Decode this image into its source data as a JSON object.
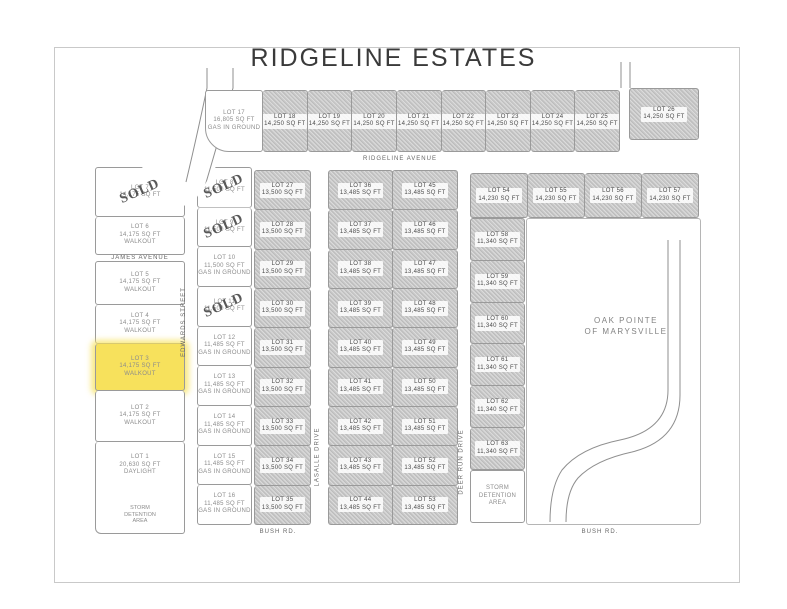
{
  "title": "RIDGELINE ESTATES",
  "stamps": {
    "sold": "SOLD"
  },
  "colors": {
    "highlight_yellow": "#f7e15c",
    "shaded_lot_gray": "#c8c8c8",
    "line_gray": "#9a9a9a",
    "text_gray": "#8c8c8c"
  },
  "streets": {
    "ridgeline": "RIDGELINE AVENUE",
    "james": "JAMES AVENUE",
    "edwards": "EDWARDS STREET",
    "lasalle": "LASALLE DRIVE",
    "deer_run": "DEER RUN DRIVE",
    "bush_left": "BUSH RD.",
    "bush_right": "BUSH RD."
  },
  "areas": {
    "oak_pointe_1": "OAK POINTE",
    "oak_pointe_2": "OF MARYSVILLE"
  },
  "lots": {
    "top_row": [
      {
        "label": "LOT 17",
        "area": "16,805 SQ FT",
        "note": "GAS IN GROUND",
        "state": "white"
      },
      {
        "label": "LOT 18",
        "area": "14,250 SQ FT",
        "state": "shaded"
      },
      {
        "label": "LOT 19",
        "area": "14,250 SQ FT",
        "state": "shaded"
      },
      {
        "label": "LOT 20",
        "area": "14,250 SQ FT",
        "state": "shaded"
      },
      {
        "label": "LOT 21",
        "area": "14,250 SQ FT",
        "state": "shaded"
      },
      {
        "label": "LOT 22",
        "area": "14,250 SQ FT",
        "state": "shaded"
      },
      {
        "label": "LOT 23",
        "area": "14,250 SQ FT",
        "state": "shaded"
      },
      {
        "label": "LOT 24",
        "area": "14,250 SQ FT",
        "state": "shaded"
      },
      {
        "label": "LOT 25",
        "area": "14,250 SQ FT",
        "state": "shaded"
      }
    ],
    "top_right": [
      {
        "label": "LOT 26",
        "area": "14,250 SQ FT",
        "state": "shaded"
      }
    ],
    "left_column": [
      {
        "label": "LOT 7",
        "area": "14,175 SQ FT",
        "state": "white",
        "sold": true
      },
      {
        "label": "LOT 6",
        "area": "14,175 SQ FT",
        "note": "WALKOUT",
        "state": "white"
      },
      {
        "street": "JAMES AVENUE"
      },
      {
        "label": "LOT 5",
        "area": "14,175 SQ FT",
        "note": "WALKOUT",
        "state": "white"
      },
      {
        "label": "LOT 4",
        "area": "14,175 SQ FT",
        "note": "WALKOUT",
        "state": "white"
      },
      {
        "label": "LOT 3",
        "area": "14,175 SQ FT",
        "note": "WALKOUT",
        "state": "highlight"
      },
      {
        "label": "LOT 2",
        "area": "14,175 SQ FT",
        "note": "WALKOUT",
        "state": "white"
      },
      {
        "label": "LOT 1",
        "area": "20,630 SQ FT",
        "note": "DAYLIGHT",
        "state": "white",
        "extra": "STORM DETENTION AREA"
      }
    ],
    "edwards_column": [
      {
        "label": "LOT 8",
        "area": "11,500 SQ FT",
        "state": "white",
        "sold": true
      },
      {
        "label": "LOT 9",
        "area": "11,500 SQ FT",
        "state": "white",
        "sold": true
      },
      {
        "label": "LOT 10",
        "area": "11,500 SQ FT",
        "note": "GAS IN GROUND",
        "state": "white"
      },
      {
        "label": "LOT 11",
        "area": "11,500 SQ FT",
        "state": "white",
        "sold": true
      },
      {
        "label": "LOT 12",
        "area": "11,485 SQ FT",
        "note": "GAS IN GROUND",
        "state": "white"
      },
      {
        "label": "LOT 13",
        "area": "11,485 SQ FT",
        "note": "GAS IN GROUND",
        "state": "white"
      },
      {
        "label": "LOT 14",
        "area": "11,485 SQ FT",
        "note": "GAS IN GROUND",
        "state": "white"
      },
      {
        "label": "LOT 15",
        "area": "11,485 SQ FT",
        "note": "GAS IN GROUND",
        "state": "white"
      },
      {
        "label": "LOT 16",
        "area": "11,485 SQ FT",
        "note": "GAS IN GROUND",
        "state": "white"
      }
    ],
    "mid_column": [
      {
        "label": "LOT 27",
        "area": "13,500 SQ FT",
        "state": "shaded"
      },
      {
        "label": "LOT 28",
        "area": "13,500 SQ FT",
        "state": "shaded"
      },
      {
        "label": "LOT 29",
        "area": "13,500 SQ FT",
        "state": "shaded"
      },
      {
        "label": "LOT 30",
        "area": "13,500 SQ FT",
        "state": "shaded"
      },
      {
        "label": "LOT 31",
        "area": "13,500 SQ FT",
        "state": "shaded"
      },
      {
        "label": "LOT 32",
        "area": "13,500 SQ FT",
        "state": "shaded"
      },
      {
        "label": "LOT 33",
        "area": "13,500 SQ FT",
        "state": "shaded"
      },
      {
        "label": "LOT 34",
        "area": "13,500 SQ FT",
        "state": "shaded"
      },
      {
        "label": "LOT 35",
        "area": "13,500 SQ FT",
        "state": "shaded"
      }
    ],
    "center_block_west": [
      {
        "label": "LOT 36",
        "area": "13,485 SQ FT",
        "state": "shaded"
      },
      {
        "label": "LOT 37",
        "area": "13,485 SQ FT",
        "state": "shaded"
      },
      {
        "label": "LOT 38",
        "area": "13,485 SQ FT",
        "state": "shaded"
      },
      {
        "label": "LOT 39",
        "area": "13,485 SQ FT",
        "state": "shaded"
      },
      {
        "label": "LOT 40",
        "area": "13,485 SQ FT",
        "state": "shaded"
      },
      {
        "label": "LOT 41",
        "area": "13,485 SQ FT",
        "state": "shaded"
      },
      {
        "label": "LOT 42",
        "area": "13,485 SQ FT",
        "state": "shaded"
      },
      {
        "label": "LOT 43",
        "area": "13,485 SQ FT",
        "state": "shaded"
      },
      {
        "label": "LOT 44",
        "area": "13,485 SQ FT",
        "state": "shaded"
      }
    ],
    "center_block_east": [
      {
        "label": "LOT 45",
        "area": "13,485 SQ FT",
        "state": "shaded"
      },
      {
        "label": "LOT 46",
        "area": "13,485 SQ FT",
        "state": "shaded"
      },
      {
        "label": "LOT 47",
        "area": "13,485 SQ FT",
        "state": "shaded"
      },
      {
        "label": "LOT 48",
        "area": "13,485 SQ FT",
        "state": "shaded"
      },
      {
        "label": "LOT 49",
        "area": "13,485 SQ FT",
        "state": "shaded"
      },
      {
        "label": "LOT 50",
        "area": "13,485 SQ FT",
        "state": "shaded"
      },
      {
        "label": "LOT 51",
        "area": "13,485 SQ FT",
        "state": "shaded"
      },
      {
        "label": "LOT 52",
        "area": "13,485 SQ FT",
        "state": "shaded"
      },
      {
        "label": "LOT 53",
        "area": "13,485 SQ FT",
        "state": "shaded"
      }
    ],
    "right_row": [
      {
        "label": "LOT 54",
        "area": "14,230 SQ FT",
        "state": "shaded"
      },
      {
        "label": "LOT 55",
        "area": "14,230 SQ FT",
        "state": "shaded"
      },
      {
        "label": "LOT 56",
        "area": "14,230 SQ FT",
        "state": "shaded"
      },
      {
        "label": "LOT 57",
        "area": "14,230 SQ FT",
        "state": "shaded"
      }
    ],
    "right_column": [
      {
        "label": "LOT 58",
        "area": "11,340 SQ FT",
        "state": "shaded"
      },
      {
        "label": "LOT 59",
        "area": "11,340 SQ FT",
        "state": "shaded"
      },
      {
        "label": "LOT 60",
        "area": "11,340 SQ FT",
        "state": "shaded"
      },
      {
        "label": "LOT 61",
        "area": "11,340 SQ FT",
        "state": "shaded"
      },
      {
        "label": "LOT 62",
        "area": "11,340 SQ FT",
        "state": "shaded"
      },
      {
        "label": "LOT 63",
        "area": "11,340 SQ FT",
        "state": "shaded"
      }
    ],
    "detention": [
      {
        "label": "STORM DETENTION AREA",
        "state": "detention"
      }
    ]
  }
}
